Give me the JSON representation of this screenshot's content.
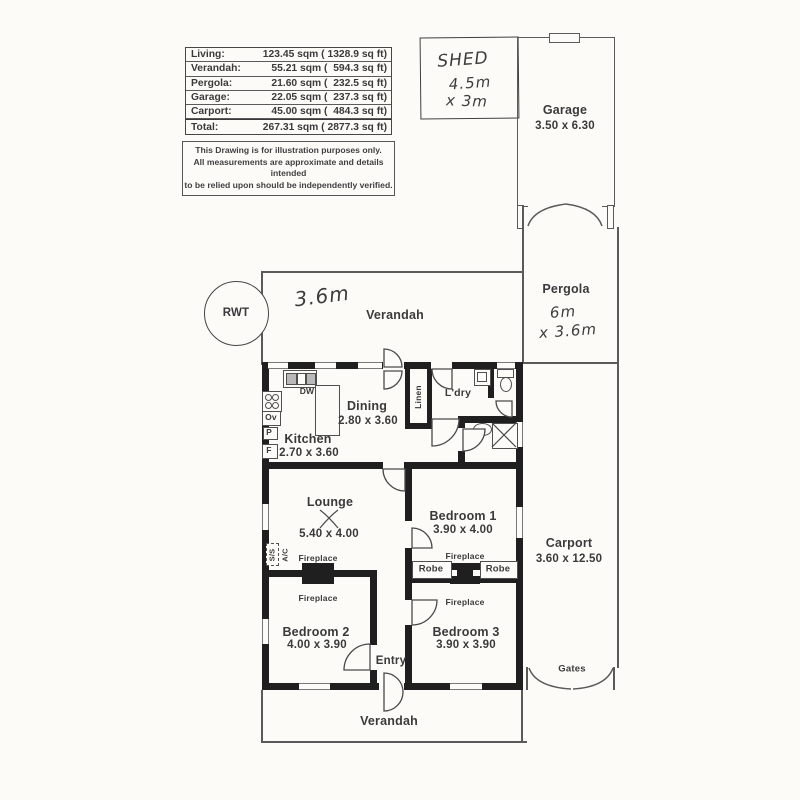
{
  "area_table": {
    "rows": [
      {
        "label": "Living:",
        "value": "123.45 sqm ( 1328.9 sq ft)"
      },
      {
        "label": "Verandah:",
        "value": "55.21 sqm (  594.3 sq ft)"
      },
      {
        "label": "Pergola:",
        "value": "21.60 sqm (  232.5 sq ft)"
      },
      {
        "label": "Garage:",
        "value": "22.05 sqm (  237.3 sq ft)"
      },
      {
        "label": "Carport:",
        "value": "45.00 sqm (  484.3 sq ft)"
      },
      {
        "label": "Total:",
        "value": "267.31 sqm ( 2877.3 sq ft)"
      }
    ]
  },
  "disclaimer": {
    "lines": [
      "This Drawing is for illustration purposes only.",
      "All measurements are approximate and details intended",
      "to be relied upon should be independently verified."
    ]
  },
  "handwritten": {
    "shed_title": "SHED",
    "shed_dim1": "4.5m",
    "shed_dim2": "x 3m",
    "verandah_depth": "3.6m",
    "pergola_dim1": "6m",
    "pergola_dim2": "x 3.6m"
  },
  "outdoor": {
    "garage": {
      "name": "Garage",
      "dim": "3.50 x 6.30"
    },
    "pergola": {
      "name": "Pergola"
    },
    "carport": {
      "name": "Carport",
      "dim": "3.60 x 12.50"
    },
    "gates_label": "Gates",
    "rwt_label": "RWT",
    "verandah_top": "Verandah",
    "verandah_bottom": "Verandah"
  },
  "rooms": {
    "dining": {
      "name": "Dining",
      "dim": "2.80 x 3.60"
    },
    "kitchen": {
      "name": "Kitchen",
      "dim": "2.70 x 3.60"
    },
    "laundry": {
      "name": "L'dry"
    },
    "linen": {
      "name": "Linen"
    },
    "lounge": {
      "name": "Lounge",
      "dim": "5.40 x 4.00"
    },
    "bedroom1": {
      "name": "Bedroom 1",
      "dim": "3.90 x 4.00"
    },
    "bedroom2": {
      "name": "Bedroom 2",
      "dim": "4.00 x 3.90"
    },
    "bedroom3": {
      "name": "Bedroom 3",
      "dim": "3.90 x 3.90"
    },
    "entry": {
      "name": "Entry"
    }
  },
  "fixtures": {
    "dishwasher": "DW",
    "oven": "Ov",
    "pantry": "P",
    "fridge": "F",
    "fireplace": "Fireplace",
    "robe": "Robe",
    "ac_line1": "S/S",
    "ac_line2": "A/C"
  },
  "colors": {
    "wall": "#1f1f1f",
    "line": "#5a5a5a",
    "text": "#3a3a3a",
    "paper": "#fcfbf8"
  }
}
